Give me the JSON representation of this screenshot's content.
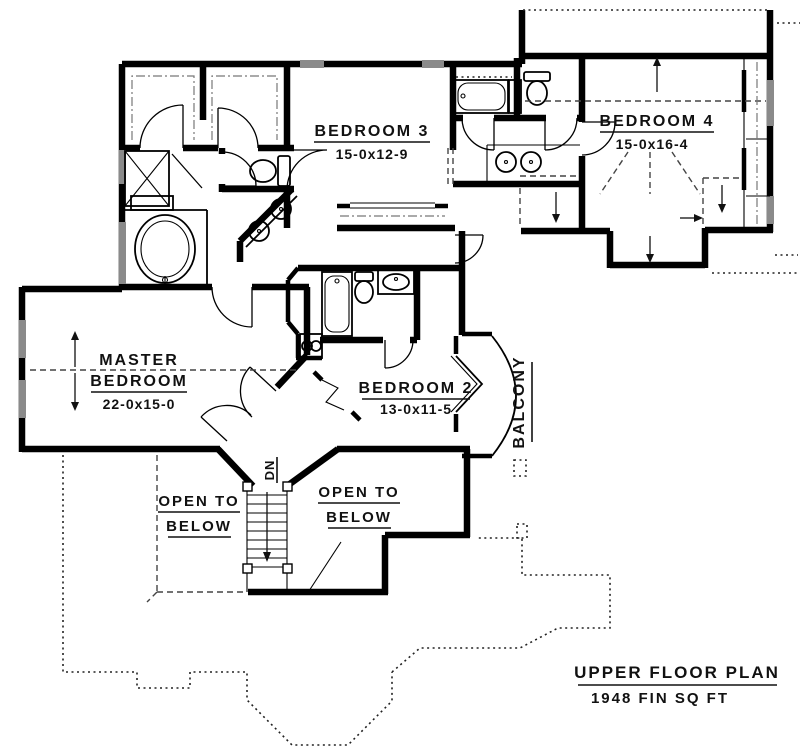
{
  "plan": {
    "rooms": {
      "master": {
        "lines": [
          "MASTER",
          "BEDROOM"
        ],
        "dims": "22-0x15-0"
      },
      "bedroom2": {
        "name": "BEDROOM 2",
        "dims": "13-0x11-5"
      },
      "bedroom3": {
        "name": "BEDROOM 3",
        "dims": "15-0x12-9"
      },
      "bedroom4": {
        "name": "BEDROOM 4",
        "dims": "15-0x16-4"
      },
      "balcony": {
        "name": "BALCONY"
      }
    },
    "annotations": {
      "open_below_left": {
        "line1": "OPEN TO",
        "line2": "BELOW"
      },
      "open_below_right": {
        "line1": "OPEN TO",
        "line2": "BELOW"
      },
      "stair_direction": "DN"
    },
    "title": {
      "line1": "UPPER FLOOR PLAN",
      "line2": "1948 FIN SQ FT"
    },
    "colors": {
      "wall": "#000000",
      "window": "#8a8a8a",
      "background": "#ffffff"
    }
  }
}
